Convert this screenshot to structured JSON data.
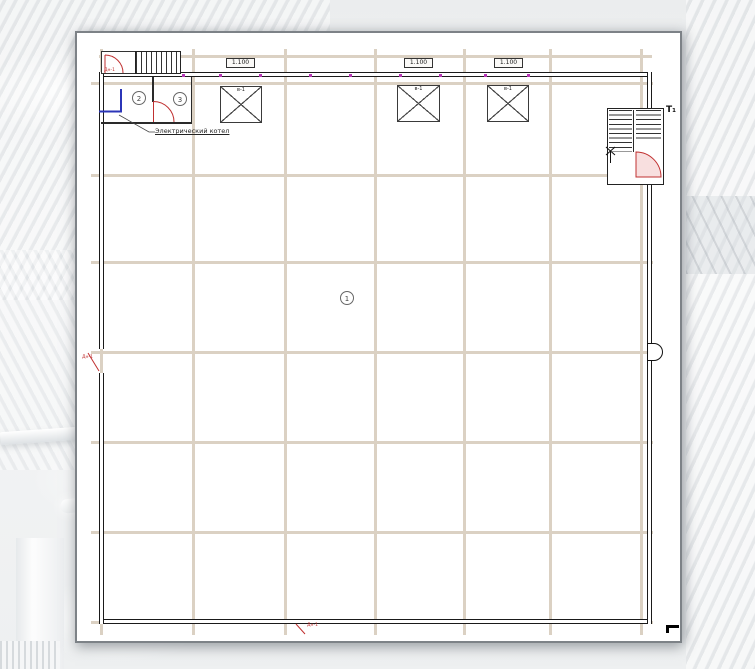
{
  "plan": {
    "rooms": [
      {
        "number": "1"
      },
      {
        "number": "2"
      },
      {
        "number": "3"
      }
    ],
    "boiler_label": "Электрический котел",
    "window_marks": [
      "1.100",
      "1.100",
      "1.100"
    ],
    "shaft_label": "в-1",
    "door_tag": "Дн-1",
    "stair_mark": "Т₁",
    "colors": {
      "grid_axis": "#dbd1c3",
      "wall": "#1a1a1a",
      "door_red": "#c03030",
      "boiler_blue": "#2b35b8",
      "fixture_magenta": "#b535b5",
      "sheet_border": "#7d8287"
    }
  }
}
